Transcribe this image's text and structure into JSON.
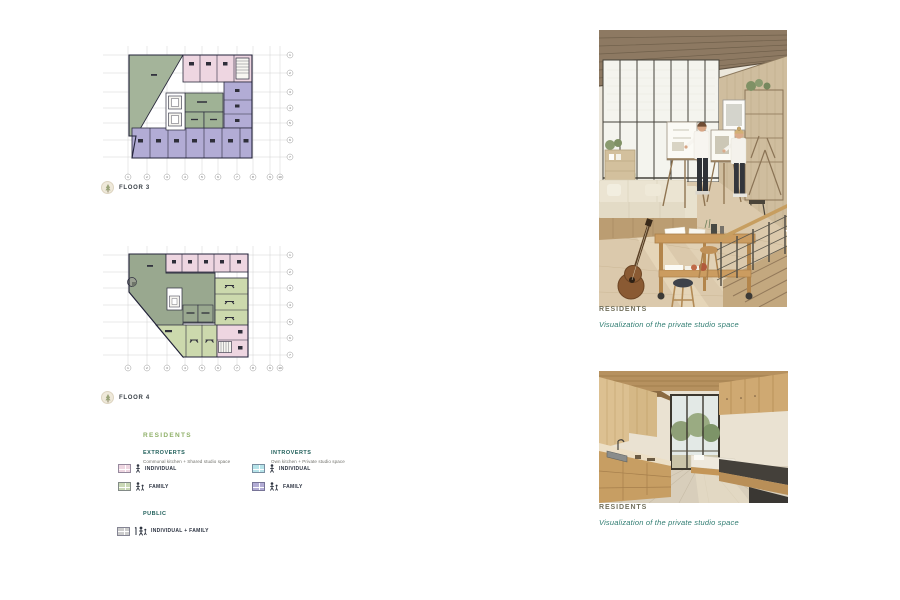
{
  "floor_plans": [
    {
      "label": "FLOOR 3",
      "row_labels": [
        "1",
        "2",
        "3",
        "4",
        "5",
        "6",
        "7"
      ],
      "col_labels": [
        "1",
        "2",
        "3",
        "4",
        "5",
        "6",
        "7",
        "8",
        "9",
        "10"
      ]
    },
    {
      "label": "FLOOR 4",
      "row_labels": [
        "1",
        "2",
        "3",
        "4",
        "5",
        "6",
        "7"
      ],
      "col_labels": [
        "1",
        "2",
        "3",
        "4",
        "5",
        "6",
        "7",
        "8",
        "9",
        "10"
      ]
    }
  ],
  "legend": {
    "title": "RESIDENTS",
    "groups": [
      {
        "name": "EXTROVERTS",
        "subtitle": "Communal kitchen + Shared studio space",
        "items": [
          {
            "label": "INDIVIDUAL",
            "color": "#eed6e1"
          },
          {
            "label": "FAMILY",
            "color": "#c9d8b5"
          }
        ]
      },
      {
        "name": "INTROVERTS",
        "subtitle": "Own kitchen + Private studio space",
        "items": [
          {
            "label": "INDIVIDUAL",
            "color": "#b6e3e9"
          },
          {
            "label": "FAMILY",
            "color": "#b2acd5"
          }
        ]
      },
      {
        "name": "PUBLIC",
        "subtitle": "",
        "items": [
          {
            "label": "INDIVIDUAL + FAMILY",
            "color": "#cccccc"
          }
        ]
      }
    ]
  },
  "renders": [
    {
      "title": "RESIDENTS",
      "caption": "Visualization of the private studio space"
    },
    {
      "title": "RESIDENTS",
      "caption": "Visualization of the private studio space"
    }
  ],
  "colors": {
    "plan_outline": "#23233a",
    "communal_green": "#a4b49a",
    "communal_green_dark": "#99a88f",
    "light_green_room": "#ccd9ad",
    "accent_green": "#8fb068",
    "teal_header": "#1e5e59",
    "caption_teal": "#2f7c71"
  }
}
